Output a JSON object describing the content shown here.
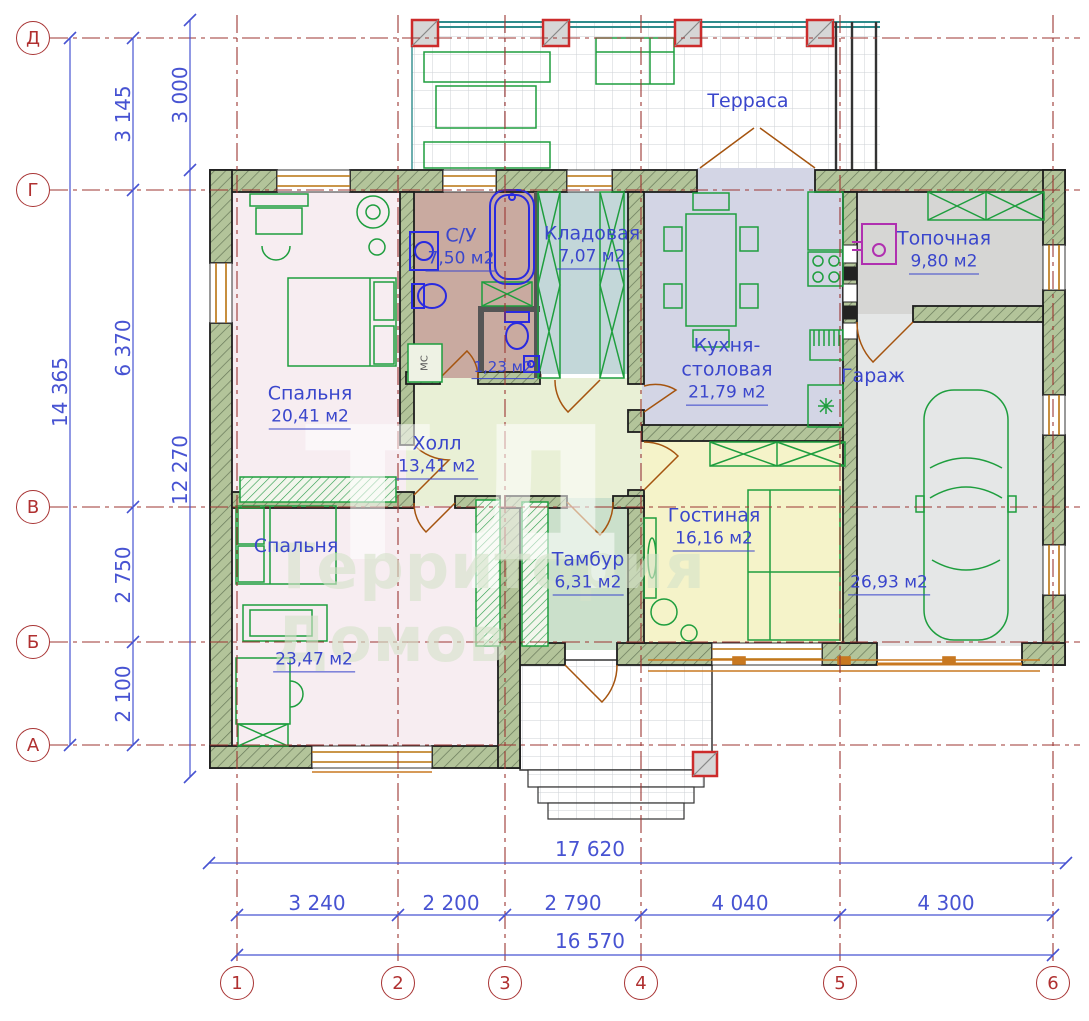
{
  "axes": {
    "rows": [
      {
        "label": "Д"
      },
      {
        "label": "Г"
      },
      {
        "label": "В"
      },
      {
        "label": "Б"
      },
      {
        "label": "А"
      }
    ],
    "cols": [
      {
        "label": "1"
      },
      {
        "label": "2"
      },
      {
        "label": "3"
      },
      {
        "label": "4"
      },
      {
        "label": "5"
      },
      {
        "label": "6"
      }
    ]
  },
  "dims": {
    "left_total": "14 365",
    "left_seg": [
      "3 145",
      "6 370",
      "2 750",
      "2 100"
    ],
    "left_inner_top": "3 000",
    "left_inner": "12 270",
    "bottom_outer": "17 620",
    "bottom_seg": [
      "3 240",
      "2 200",
      "2 790",
      "4 040",
      "4 300"
    ],
    "bottom_inner": "16 570"
  },
  "rooms": {
    "terrace": {
      "name": "Терраса"
    },
    "bedroom1": {
      "name": "Спальня",
      "area": "20,41 м2"
    },
    "bath": {
      "name": "С/У",
      "area": "7,50 м2"
    },
    "wc": {
      "area": "1,23 м2"
    },
    "storage": {
      "name": "Кладовая",
      "area": "7,07 м2"
    },
    "kitchen": {
      "name": "Кухня-столовая",
      "area": "21,79 м2"
    },
    "boiler": {
      "name": "Топочная",
      "area": "9,80 м2"
    },
    "garage": {
      "name": "Гараж",
      "area": "26,93 м2"
    },
    "hall": {
      "name": "Холл",
      "area": "13,41 м2"
    },
    "bedroom2": {
      "name": "Спальня",
      "area": "23,47 м2"
    },
    "vestibule": {
      "name": "Тамбур",
      "area": "6,31 м2"
    },
    "living": {
      "name": "Гостиная",
      "area": "16,16 м2"
    },
    "closet_label": "МС"
  },
  "watermark": {
    "logo": "ТД",
    "text": "Территория Домов"
  },
  "colors": {
    "axis_red": "#9c3532",
    "dim_blue": "#4753d2",
    "label_blue": "#3a46cc",
    "wall_fill": "#b3c49a",
    "furniture_green": "#1e9e3e",
    "sanitary_blue": "#2a2ae0",
    "boiler_magenta": "#b030b0",
    "door_brown": "#a5540f",
    "column_red": "#cc2b2b"
  }
}
